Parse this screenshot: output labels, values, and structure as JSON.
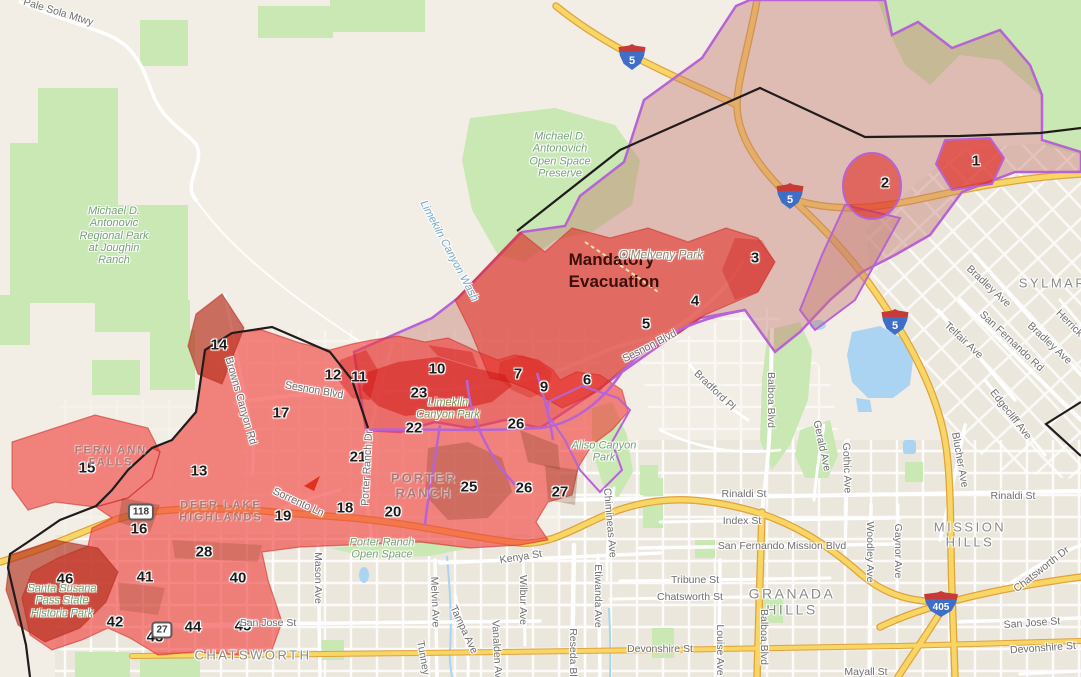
{
  "map": {
    "title": "Evacuation zones map",
    "colors": {
      "base": "#f2eee5",
      "urban": "#ebe7dd",
      "park_green": "#c9e8b4",
      "water_blue": "#aad4f2",
      "highway_fill": "#f8d664",
      "highway_casing": "#dfa23f",
      "zone_red": "rgba(240,62,58,0.62)",
      "mandatory_red": "rgba(228,40,32,0.55)",
      "dark_red": "rgba(205,10,10,0.45)",
      "warning_fill": "rgba(195,120,110,0.42)",
      "overlap_brown": "rgba(115,58,25,0.28)",
      "boundary_purple": "#b763d6",
      "fire_line": "#201c1c",
      "shield_red": "#c63b37",
      "shield_blue": "#3e6ec7",
      "street_label": "#6f6f6f",
      "city_label": "#8a8a8a",
      "neighborhood_label": "#a97c78",
      "park_label": "#74a476",
      "water_label": "#74a9c9",
      "zone_number": "#1c1c1c",
      "mandatory_text": "#3c0f0a"
    },
    "zones": [
      {
        "n": "1",
        "x": 976,
        "y": 161
      },
      {
        "n": "2",
        "x": 885,
        "y": 183
      },
      {
        "n": "3",
        "x": 755,
        "y": 258
      },
      {
        "n": "4",
        "x": 695,
        "y": 301
      },
      {
        "n": "5",
        "x": 646,
        "y": 324
      },
      {
        "n": "6",
        "x": 587,
        "y": 380
      },
      {
        "n": "7",
        "x": 518,
        "y": 374
      },
      {
        "n": "9",
        "x": 544,
        "y": 387
      },
      {
        "n": "10",
        "x": 437,
        "y": 369
      },
      {
        "n": "11",
        "x": 359,
        "y": 377
      },
      {
        "n": "12",
        "x": 333,
        "y": 375
      },
      {
        "n": "13",
        "x": 199,
        "y": 471
      },
      {
        "n": "14",
        "x": 219,
        "y": 345
      },
      {
        "n": "15",
        "x": 87,
        "y": 468
      },
      {
        "n": "16",
        "x": 139,
        "y": 529
      },
      {
        "n": "17",
        "x": 281,
        "y": 413
      },
      {
        "n": "18",
        "x": 345,
        "y": 508
      },
      {
        "n": "19",
        "x": 283,
        "y": 516
      },
      {
        "n": "20",
        "x": 393,
        "y": 512
      },
      {
        "n": "21",
        "x": 358,
        "y": 457
      },
      {
        "n": "22",
        "x": 414,
        "y": 428
      },
      {
        "n": "23",
        "x": 419,
        "y": 393
      },
      {
        "n": "25",
        "x": 469,
        "y": 487
      },
      {
        "n": "26",
        "x": 516,
        "y": 424
      },
      {
        "n": "26",
        "x": 524,
        "y": 488
      },
      {
        "n": "27",
        "x": 560,
        "y": 492
      },
      {
        "n": "28",
        "x": 204,
        "y": 552
      },
      {
        "n": "40",
        "x": 238,
        "y": 578
      },
      {
        "n": "41",
        "x": 145,
        "y": 577
      },
      {
        "n": "42",
        "x": 115,
        "y": 622
      },
      {
        "n": "43",
        "x": 155,
        "y": 637
      },
      {
        "n": "44",
        "x": 193,
        "y": 627
      },
      {
        "n": "45",
        "x": 243,
        "y": 626
      },
      {
        "n": "46",
        "x": 65,
        "y": 579
      }
    ],
    "labels": [
      {
        "cls": "mandatory",
        "name": "mandatory-evacuation-label",
        "lines": [
          "Mandatory",
          "Evacuation"
        ],
        "x": 614,
        "y": 271
      },
      {
        "cls": "city",
        "name": "city-label-sylmar",
        "text": "SYLMAR",
        "x": 1053,
        "y": 284
      },
      {
        "cls": "city",
        "name": "city-label-mission-hills",
        "lines": [
          "MISSION",
          "HILLS"
        ],
        "x": 970,
        "y": 535
      },
      {
        "cls": "city",
        "name": "city-label-granada-hills",
        "lines": [
          "GRANADA",
          "HILLS"
        ],
        "x": 792,
        "y": 602,
        "size": 14
      },
      {
        "cls": "city",
        "name": "city-label-chatsworth",
        "text": "CHATSWORTH",
        "x": 253,
        "y": 656
      },
      {
        "cls": "nbhd",
        "name": "label-fern-ann-falls",
        "lines": [
          "FERN ANN",
          "FALLS"
        ],
        "x": 111,
        "y": 457
      },
      {
        "cls": "nbhd",
        "name": "label-deer-lake-highlands",
        "lines": [
          "DEER LAKE",
          "HIGHLANDS"
        ],
        "x": 221,
        "y": 512
      },
      {
        "cls": "nbhd",
        "name": "label-porter-ranch",
        "lines": [
          "PORTER",
          "RANCH"
        ],
        "x": 424,
        "y": 486,
        "size": 13
      },
      {
        "cls": "park",
        "name": "park-label-antonovic-regional",
        "lines": [
          "Michael D.",
          "Antonovic",
          "Regional Park",
          "at Joughin",
          "Ranch"
        ],
        "x": 114,
        "y": 236
      },
      {
        "cls": "park",
        "name": "park-label-antonovich-preserve",
        "lines": [
          "Michael D.",
          "Antonovich",
          "Open Space",
          "Preserve"
        ],
        "x": 560,
        "y": 155
      },
      {
        "cls": "park",
        "name": "park-label-santa-susana",
        "lines": [
          "Santa Susana",
          "Pass State",
          "Historic Park"
        ],
        "x": 62,
        "y": 601
      },
      {
        "cls": "park",
        "name": "park-label-porter-ranch-open-space",
        "lines": [
          "Porter Ranch",
          "Open Space"
        ],
        "x": 382,
        "y": 549
      },
      {
        "cls": "park",
        "name": "park-label-aliso-canyon",
        "lines": [
          "Aliso Canyon",
          "Park"
        ],
        "x": 604,
        "y": 452
      },
      {
        "cls": "park",
        "name": "park-label-limekiln-canyon",
        "lines": [
          "Limekiln",
          "Canyon Park"
        ],
        "x": 448,
        "y": 409,
        "color": "#7a9455"
      },
      {
        "cls": "park",
        "name": "park-label-omelveny",
        "text": "O'Melveny Park",
        "x": 661,
        "y": 255,
        "size": 12,
        "color": "#8e8a72"
      },
      {
        "cls": "water",
        "name": "water-label-limekiln-wash",
        "text": "Limekiln Canyon Wash",
        "x": 449,
        "y": 251,
        "rot": 62
      },
      {
        "cls": "street",
        "name": "street-label",
        "text": "Pale Sola Mtwy",
        "x": 58,
        "y": 13,
        "rot": 17
      },
      {
        "cls": "street",
        "name": "street-label",
        "text": "Sesnon Blvd",
        "x": 314,
        "y": 391,
        "rot": 10
      },
      {
        "cls": "street",
        "name": "street-label",
        "text": "Sesnon Blvd",
        "x": 650,
        "y": 347,
        "rot": -27
      },
      {
        "cls": "street",
        "name": "street-label",
        "text": "Bradford Pl",
        "x": 714,
        "y": 391,
        "rot": 44
      },
      {
        "cls": "street",
        "name": "street-label",
        "text": "Balboa Blvd",
        "x": 770,
        "y": 400,
        "rot": 90
      },
      {
        "cls": "street",
        "name": "street-label",
        "text": "Balboa Blvd",
        "x": 763,
        "y": 637,
        "rot": 90
      },
      {
        "cls": "street",
        "name": "street-label",
        "text": "Rinaldi St",
        "x": 744,
        "y": 495
      },
      {
        "cls": "street",
        "name": "street-label",
        "text": "Rinaldi St",
        "x": 1013,
        "y": 497
      },
      {
        "cls": "street",
        "name": "street-label",
        "text": "Index St",
        "x": 742,
        "y": 522
      },
      {
        "cls": "street",
        "name": "street-label",
        "text": "San Fernando Mission Blvd",
        "x": 782,
        "y": 547
      },
      {
        "cls": "street",
        "name": "street-label",
        "text": "Tribune St",
        "x": 695,
        "y": 581
      },
      {
        "cls": "street",
        "name": "street-label",
        "text": "Chatsworth St",
        "x": 690,
        "y": 598
      },
      {
        "cls": "street",
        "name": "street-label",
        "text": "Devonshire St",
        "x": 660,
        "y": 650
      },
      {
        "cls": "street",
        "name": "street-label",
        "text": "Devonshire St",
        "x": 1043,
        "y": 649,
        "rot": -4
      },
      {
        "cls": "street",
        "name": "street-label",
        "text": "San Jose St",
        "x": 268,
        "y": 624
      },
      {
        "cls": "street",
        "name": "street-label",
        "text": "San Jose St",
        "x": 1032,
        "y": 624,
        "rot": -4
      },
      {
        "cls": "street",
        "name": "street-label",
        "text": "Kenya St",
        "x": 521,
        "y": 558,
        "rot": -9
      },
      {
        "cls": "street",
        "name": "street-label",
        "text": "Mason Ave",
        "x": 317,
        "y": 578,
        "rot": 90
      },
      {
        "cls": "street",
        "name": "street-label",
        "text": "Melvin Ave",
        "x": 434,
        "y": 602,
        "rot": 88
      },
      {
        "cls": "street",
        "name": "street-label",
        "text": "Tampa Ave",
        "x": 463,
        "y": 630,
        "rot": 65
      },
      {
        "cls": "street",
        "name": "street-label",
        "text": "Wilbur Ave",
        "x": 522,
        "y": 600,
        "rot": 90
      },
      {
        "cls": "street",
        "name": "street-label",
        "text": "Etiwanda Ave",
        "x": 597,
        "y": 596,
        "rot": 90
      },
      {
        "cls": "street",
        "name": "street-label",
        "text": "Reseda Blvd",
        "x": 572,
        "y": 658,
        "rot": 90
      },
      {
        "cls": "street",
        "name": "street-label",
        "text": "Vanalden Ave",
        "x": 496,
        "y": 652,
        "rot": 87
      },
      {
        "cls": "street",
        "name": "street-label",
        "text": "Tunney Ave",
        "x": 424,
        "y": 668,
        "rot": 80
      },
      {
        "cls": "street",
        "name": "street-label",
        "text": "Chimineas Ave",
        "x": 609,
        "y": 523,
        "rot": 85
      },
      {
        "cls": "street",
        "name": "street-label",
        "text": "Louise Ave",
        "x": 719,
        "y": 650,
        "rot": 90
      },
      {
        "cls": "street",
        "name": "street-label",
        "text": "Woodley Ave",
        "x": 869,
        "y": 552,
        "rot": 90
      },
      {
        "cls": "street",
        "name": "street-label",
        "text": "Gaynor Ave",
        "x": 897,
        "y": 551,
        "rot": 90
      },
      {
        "cls": "street",
        "name": "street-label",
        "text": "Gerald Ave",
        "x": 821,
        "y": 446,
        "rot": 78
      },
      {
        "cls": "street",
        "name": "street-label",
        "text": "Gothic Ave",
        "x": 846,
        "y": 468,
        "rot": 88
      },
      {
        "cls": "street",
        "name": "street-label",
        "text": "Bradley Ave",
        "x": 988,
        "y": 287,
        "rot": 43
      },
      {
        "cls": "street",
        "name": "street-label",
        "text": "Bradley Ave",
        "x": 1049,
        "y": 344,
        "rot": 43
      },
      {
        "cls": "street",
        "name": "street-label",
        "text": "San Fernando Rd",
        "x": 1011,
        "y": 342,
        "rot": 43
      },
      {
        "cls": "street",
        "name": "street-label",
        "text": "Telfair Ave",
        "x": 963,
        "y": 341,
        "rot": 43
      },
      {
        "cls": "street",
        "name": "street-label",
        "text": "Edgecliff Ave",
        "x": 1010,
        "y": 415,
        "rot": 52
      },
      {
        "cls": "street",
        "name": "street-label",
        "text": "Herrick Ave",
        "x": 1076,
        "y": 331,
        "rot": 45
      },
      {
        "cls": "street",
        "name": "street-label",
        "text": "Blucher Ave",
        "x": 959,
        "y": 460,
        "rot": 80
      },
      {
        "cls": "street",
        "name": "street-label",
        "text": "Chatsworth Dr",
        "x": 1042,
        "y": 570,
        "rot": -38
      },
      {
        "cls": "street",
        "name": "street-label",
        "text": "Browns Canyon Rd",
        "x": 240,
        "y": 401,
        "rot": 74
      },
      {
        "cls": "street",
        "name": "street-label",
        "text": "Sorrento Ln",
        "x": 298,
        "y": 503,
        "rot": 25
      },
      {
        "cls": "street",
        "name": "street-label",
        "text": "Porter Ranch Dr",
        "x": 368,
        "y": 468,
        "rot": -87
      },
      {
        "cls": "street",
        "name": "street-label",
        "text": "Mayall St",
        "x": 866,
        "y": 673
      }
    ],
    "shields": [
      {
        "kind": "interstate",
        "num": "5",
        "x": 632,
        "y": 57
      },
      {
        "kind": "interstate",
        "num": "5",
        "x": 790,
        "y": 196
      },
      {
        "kind": "interstate",
        "num": "5",
        "x": 895,
        "y": 322
      },
      {
        "kind": "interstate",
        "num": "405",
        "x": 941,
        "y": 604,
        "wide": true
      },
      {
        "kind": "state",
        "num": "118",
        "x": 141,
        "y": 512
      },
      {
        "kind": "state",
        "num": "27",
        "x": 162,
        "y": 630
      }
    ]
  }
}
